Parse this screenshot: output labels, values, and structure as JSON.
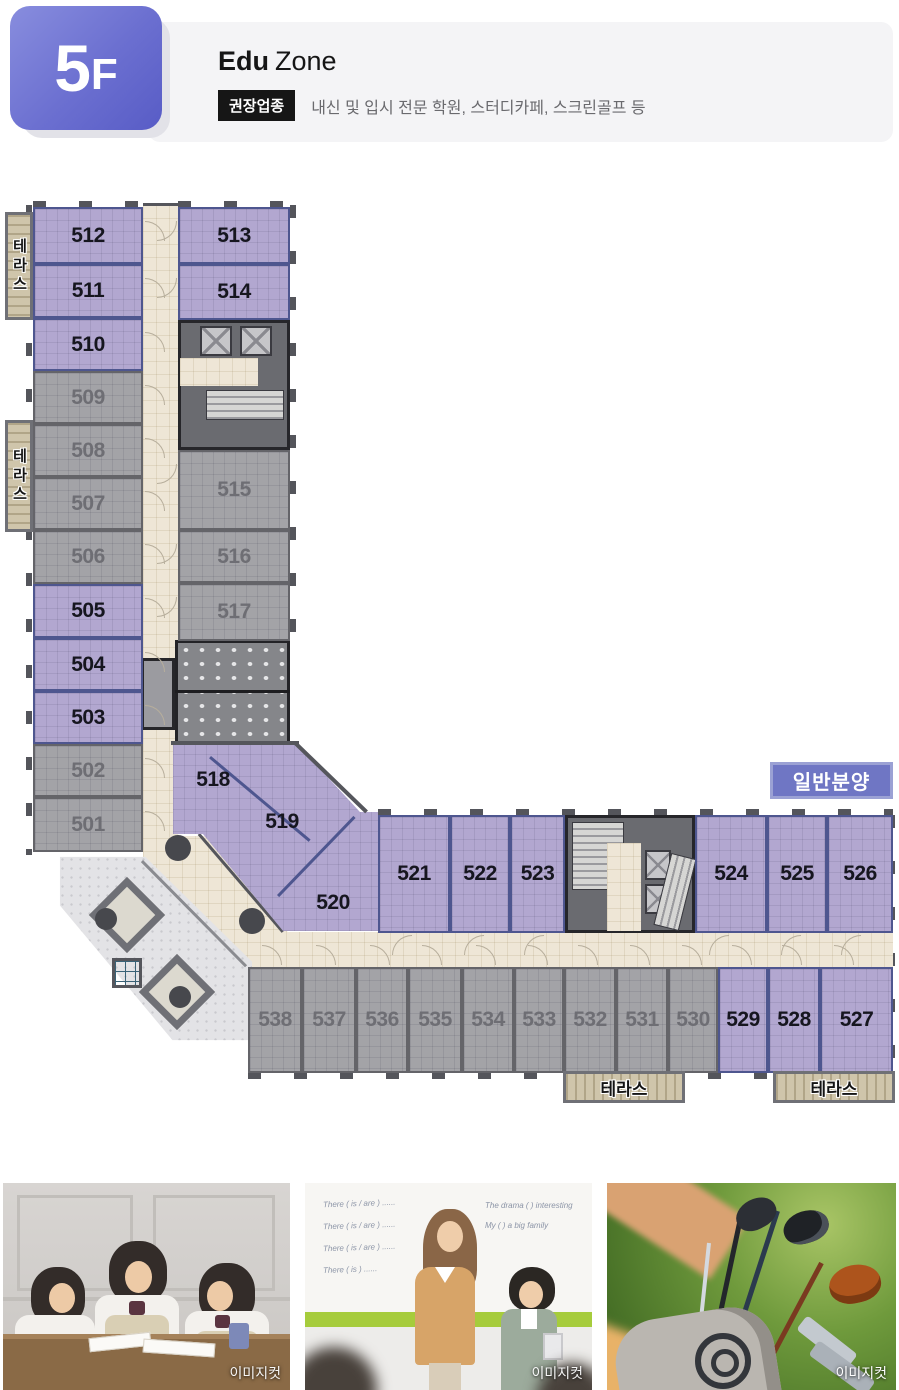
{
  "header": {
    "floor_number": "5",
    "floor_suffix": "F",
    "zone_bold": "Edu",
    "zone_rest": "Zone",
    "recommend_badge": "권장업종",
    "recommend_text": "내신 및 입시 전문 학원, 스터디카페, 스크린골프 등"
  },
  "floorplan": {
    "legend": "일반분양",
    "terrace_label": "테라스",
    "colors": {
      "general_sale_fill": "#b2a7d0",
      "other_fill": "#a3a3a7",
      "corridor_fill": "#eee6d6",
      "wall": "#55565c",
      "legend_bg": "#6f76c4"
    },
    "units": [
      {
        "n": "512",
        "t": "p",
        "x": 33,
        "y": 207,
        "w": 110,
        "h": 57
      },
      {
        "n": "511",
        "t": "p",
        "x": 33,
        "y": 264,
        "w": 110,
        "h": 54
      },
      {
        "n": "510",
        "t": "p",
        "x": 33,
        "y": 318,
        "w": 110,
        "h": 53
      },
      {
        "n": "509",
        "t": "g",
        "x": 33,
        "y": 371,
        "w": 110,
        "h": 53
      },
      {
        "n": "508",
        "t": "g",
        "x": 33,
        "y": 424,
        "w": 110,
        "h": 53
      },
      {
        "n": "507",
        "t": "g",
        "x": 33,
        "y": 477,
        "w": 110,
        "h": 53
      },
      {
        "n": "506",
        "t": "g",
        "x": 33,
        "y": 530,
        "w": 110,
        "h": 54
      },
      {
        "n": "505",
        "t": "p",
        "x": 33,
        "y": 584,
        "w": 110,
        "h": 54
      },
      {
        "n": "504",
        "t": "p",
        "x": 33,
        "y": 638,
        "w": 110,
        "h": 53
      },
      {
        "n": "503",
        "t": "p",
        "x": 33,
        "y": 691,
        "w": 110,
        "h": 53
      },
      {
        "n": "502",
        "t": "g",
        "x": 33,
        "y": 744,
        "w": 110,
        "h": 53
      },
      {
        "n": "501",
        "t": "g",
        "x": 33,
        "y": 797,
        "w": 110,
        "h": 55
      },
      {
        "n": "513",
        "t": "p",
        "x": 178,
        "y": 207,
        "w": 112,
        "h": 57
      },
      {
        "n": "514",
        "t": "p",
        "x": 178,
        "y": 264,
        "w": 112,
        "h": 56
      },
      {
        "n": "515",
        "t": "g",
        "x": 178,
        "y": 450,
        "w": 112,
        "h": 80
      },
      {
        "n": "516",
        "t": "g",
        "x": 178,
        "y": 530,
        "w": 112,
        "h": 53
      },
      {
        "n": "517",
        "t": "g",
        "x": 178,
        "y": 583,
        "w": 112,
        "h": 58
      },
      {
        "n": "518",
        "t": "p",
        "shape": "label",
        "x": 213,
        "y": 780
      },
      {
        "n": "519",
        "t": "p",
        "shape": "label",
        "x": 282,
        "y": 822
      },
      {
        "n": "520",
        "t": "p",
        "shape": "label",
        "x": 333,
        "y": 903
      },
      {
        "n": "521",
        "t": "p",
        "x": 378,
        "y": 815,
        "w": 72,
        "h": 118
      },
      {
        "n": "522",
        "t": "p",
        "x": 450,
        "y": 815,
        "w": 60,
        "h": 118
      },
      {
        "n": "523",
        "t": "p",
        "x": 510,
        "y": 815,
        "w": 55,
        "h": 118
      },
      {
        "n": "524",
        "t": "p",
        "x": 695,
        "y": 815,
        "w": 72,
        "h": 118
      },
      {
        "n": "525",
        "t": "p",
        "x": 767,
        "y": 815,
        "w": 60,
        "h": 118
      },
      {
        "n": "526",
        "t": "p",
        "x": 827,
        "y": 815,
        "w": 66,
        "h": 118
      },
      {
        "n": "538",
        "t": "g",
        "x": 248,
        "y": 967,
        "w": 54,
        "h": 106
      },
      {
        "n": "537",
        "t": "g",
        "x": 302,
        "y": 967,
        "w": 54,
        "h": 106
      },
      {
        "n": "536",
        "t": "g",
        "x": 356,
        "y": 967,
        "w": 52,
        "h": 106
      },
      {
        "n": "535",
        "t": "g",
        "x": 408,
        "y": 967,
        "w": 54,
        "h": 106
      },
      {
        "n": "534",
        "t": "g",
        "x": 462,
        "y": 967,
        "w": 52,
        "h": 106
      },
      {
        "n": "533",
        "t": "g",
        "x": 514,
        "y": 967,
        "w": 50,
        "h": 106
      },
      {
        "n": "532",
        "t": "g",
        "x": 564,
        "y": 967,
        "w": 52,
        "h": 106
      },
      {
        "n": "531",
        "t": "g",
        "x": 616,
        "y": 967,
        "w": 52,
        "h": 106
      },
      {
        "n": "530",
        "t": "g",
        "x": 668,
        "y": 967,
        "w": 50,
        "h": 106
      },
      {
        "n": "529",
        "t": "p",
        "x": 718,
        "y": 967,
        "w": 50,
        "h": 106
      },
      {
        "n": "528",
        "t": "p",
        "x": 768,
        "y": 967,
        "w": 52,
        "h": 106
      },
      {
        "n": "527",
        "t": "p",
        "x": 820,
        "y": 967,
        "w": 73,
        "h": 106
      }
    ],
    "terraces": [
      {
        "x": 5,
        "y": 212,
        "w": 28,
        "h": 108,
        "orient": "v"
      },
      {
        "x": 5,
        "y": 420,
        "w": 28,
        "h": 112,
        "orient": "v"
      },
      {
        "x": 563,
        "y": 1071,
        "w": 122,
        "h": 32,
        "orient": "h"
      },
      {
        "x": 773,
        "y": 1071,
        "w": 122,
        "h": 32,
        "orient": "h"
      }
    ]
  },
  "photos": [
    {
      "caption": "이미지컷",
      "name": "students-studying"
    },
    {
      "caption": "이미지컷",
      "name": "teacher-student-whiteboard",
      "whiteboard_left": [
        "There ( is / are ) ......",
        "There ( is / are ) ......",
        "There ( is / are ) ......",
        "There ( is ) ......"
      ],
      "whiteboard_right": [
        "The drama (    ) interesting",
        "My (    ) a big family"
      ]
    },
    {
      "caption": "이미지컷",
      "name": "golf-clubs"
    }
  ]
}
